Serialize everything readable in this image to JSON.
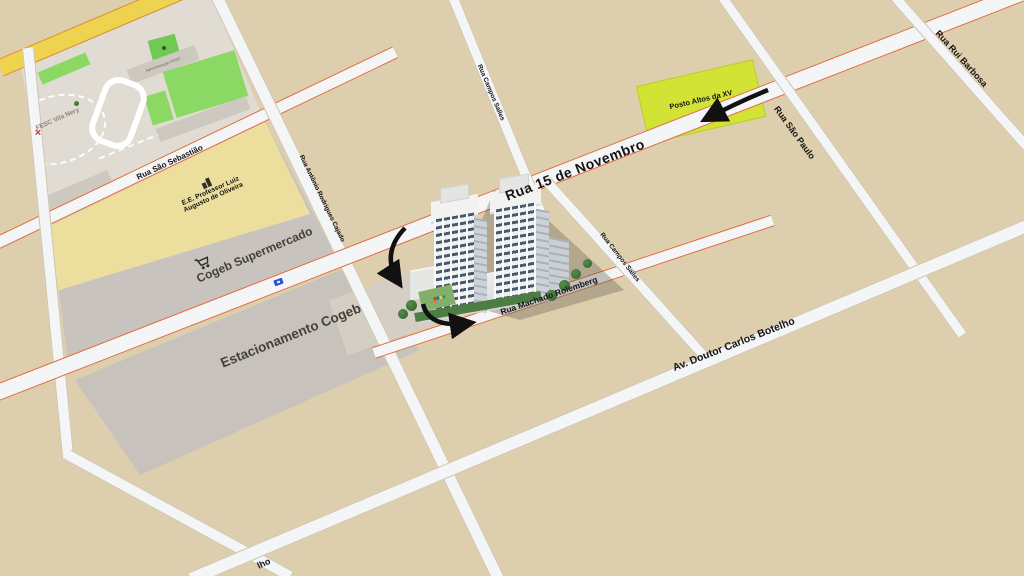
{
  "canvas": {
    "width": 1024,
    "height": 576
  },
  "streets": {
    "sao_sebastiao": "Rua São Sebastião",
    "antonio_rodrigues_cajado": "Rua Antônio Rodrigues Cajado",
    "quinze_de_novembro": "Rua 15 de Novembro",
    "campos_salles_upper": "Rua Campos Salles",
    "campos_salles_lower": "Rua Campos Salles",
    "sao_paulo": "Rua São Paulo",
    "rui_barbosa": "Rua Rui Barbosa",
    "doutor_carlos_botelho": "Av. Doutor Carlos Botelho",
    "machado_rolemberg": "Rua Machado Rolemberg",
    "botelho_cutoff_fragment": "lho"
  },
  "places": {
    "fesc": "FESC Vila Nery",
    "fesc_admin": "Administração FESC",
    "school_line1": "E.E. Professor Luiz",
    "school_line2": "Augusto de Oliveira",
    "supermercado": "Cogeb Supermercado",
    "estacionamento": "Estacionamento Cogeb",
    "posto": "Posto Altos da XV"
  },
  "icons": {
    "cart": "shopping-cart-icon",
    "school": "school-building-icon",
    "bus_stop": "bus-stop-icon",
    "fesc_marker": "red-cross-marker",
    "tree": "tree-marker",
    "route": "route-direction-arrow"
  },
  "colors": {
    "background": "#ddcfad",
    "street_fill": "#f4f5f7",
    "main_road_edge": "#e06a3a",
    "yellow_road": "#eed351",
    "fesc_block": "#e0dcd3",
    "field_green": "#8bd964",
    "school_block": "#ecdf9e",
    "commerce_block": "#c9c3bf",
    "parking_block": "#c8c2bc",
    "posto_block": "#d2e336",
    "arrow": "#111111"
  }
}
